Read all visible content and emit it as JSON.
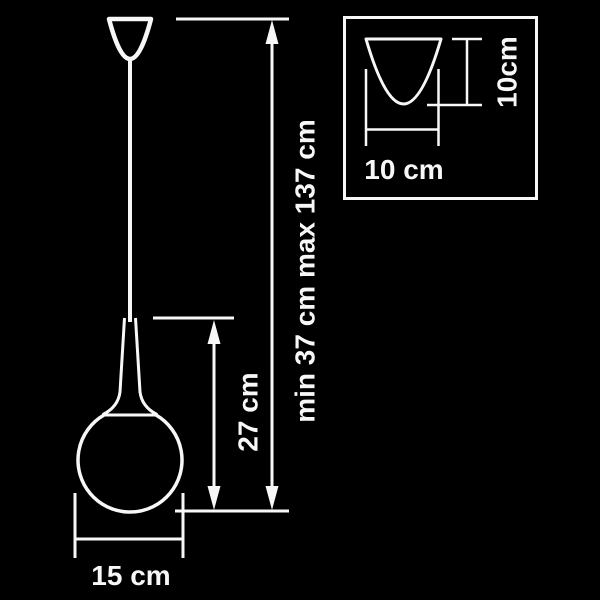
{
  "colors": {
    "background": "#000000",
    "line": "#f7f7f7"
  },
  "labels": {
    "total_height": "min 37 cm max 137 cm",
    "shade_height": "27 cm",
    "shade_diameter": "15 cm",
    "canopy_width": "10 cm",
    "canopy_height": "10cm"
  }
}
